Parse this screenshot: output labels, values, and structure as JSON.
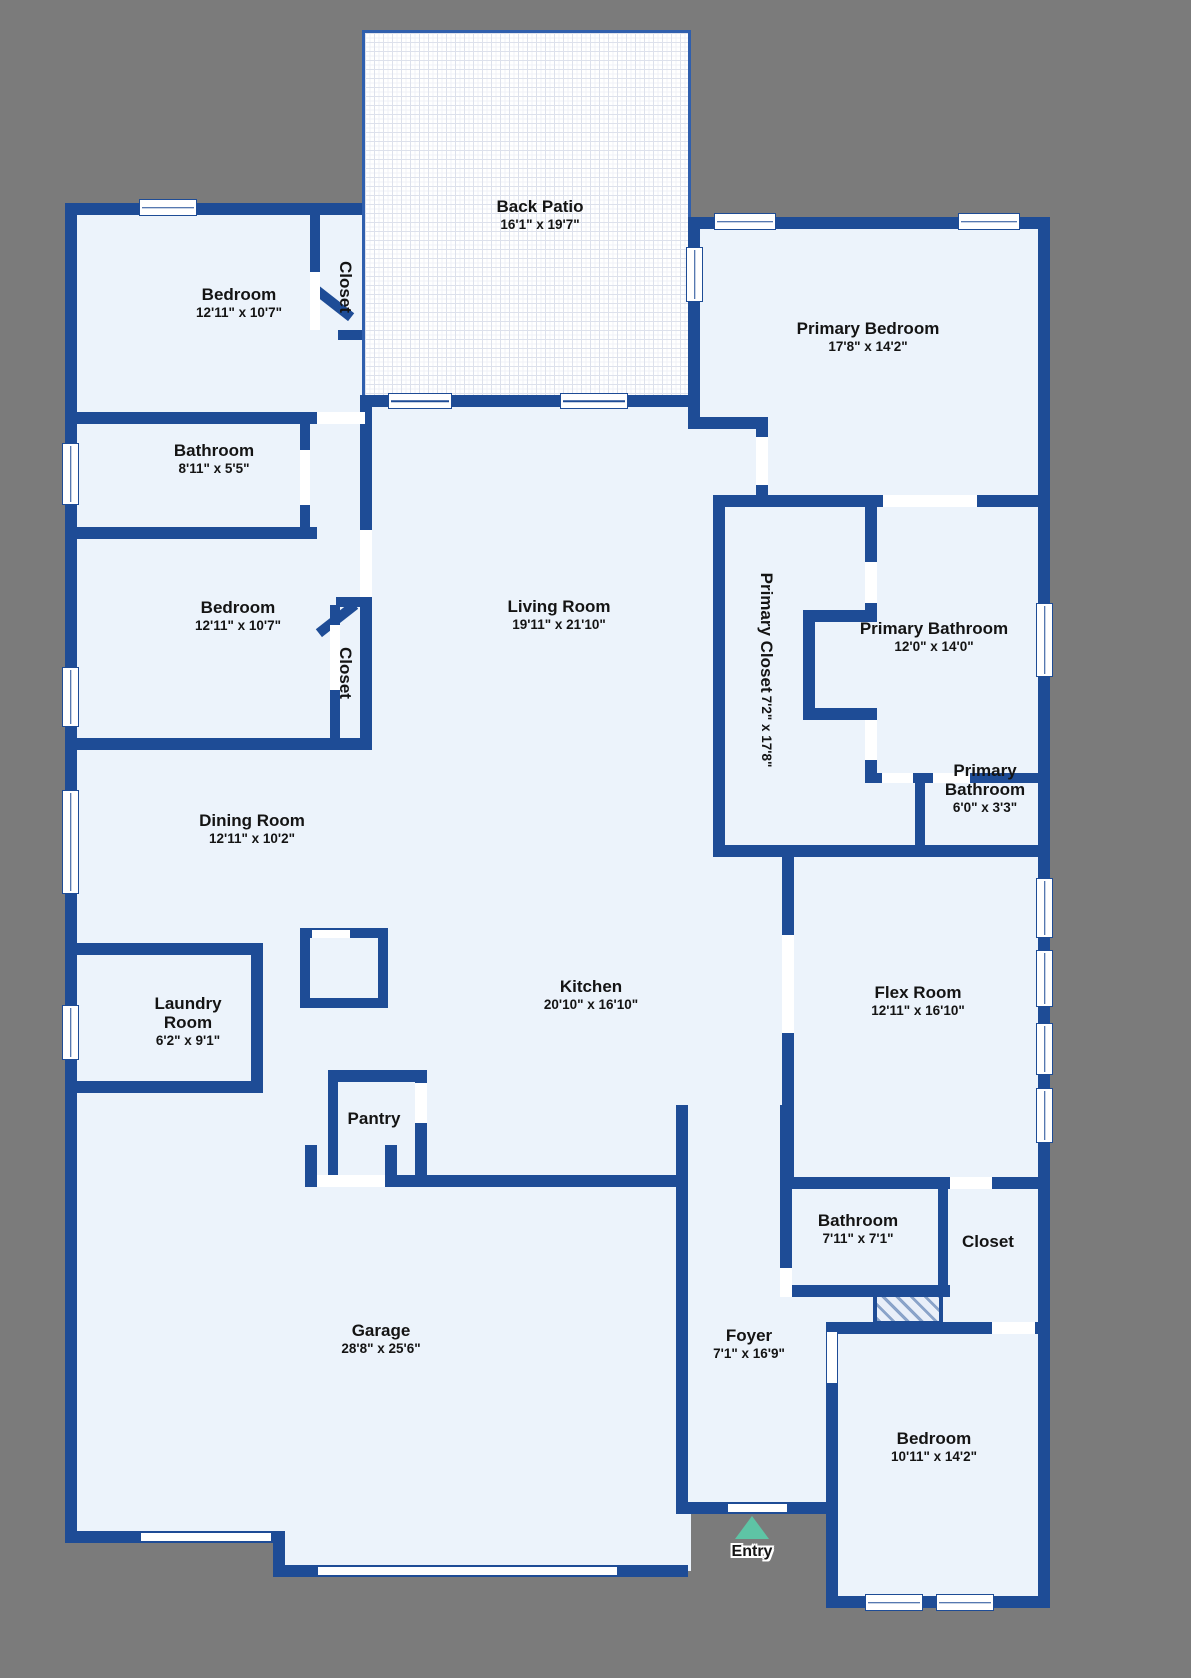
{
  "canvas": {
    "w": 1191,
    "h": 1678,
    "bg": "#7b7b7b"
  },
  "colors": {
    "wall": "#1e4c96",
    "floor": "#ecf3fb",
    "window_fill": "#ffffff",
    "door_fill": "#ffffff",
    "patio_border": "#2f5fae",
    "entry_arrow": "#5ec4a5",
    "label_text": "#141414"
  },
  "patio": {
    "x": 362,
    "y": 30,
    "w": 329,
    "h": 368
  },
  "floors": [
    [
      65,
      203,
      297,
      1340
    ],
    [
      352,
      395,
      339,
      1176
    ],
    [
      285,
      1400,
      80,
      170
    ],
    [
      688,
      217,
      362,
      1297
    ],
    [
      826,
      1322,
      224,
      286
    ]
  ],
  "walls": [
    [
      65,
      203,
      297,
      12
    ],
    [
      65,
      203,
      12,
      1340
    ],
    [
      65,
      1531,
      220,
      12
    ],
    [
      273,
      1531,
      12,
      46
    ],
    [
      273,
      1565,
      415,
      12
    ],
    [
      676,
      1105,
      12,
      409
    ],
    [
      676,
      1502,
      162,
      12
    ],
    [
      826,
      1322,
      12,
      286
    ],
    [
      826,
      1596,
      224,
      12
    ],
    [
      1038,
      217,
      12,
      1391
    ],
    [
      688,
      217,
      362,
      12
    ],
    [
      688,
      217,
      12,
      200
    ],
    [
      688,
      417,
      80,
      12
    ],
    [
      756,
      417,
      12,
      90
    ],
    [
      713,
      495,
      337,
      12
    ],
    [
      713,
      495,
      12,
      362
    ],
    [
      865,
      507,
      12,
      55
    ],
    [
      865,
      603,
      12,
      10
    ],
    [
      803,
      610,
      74,
      12
    ],
    [
      803,
      610,
      12,
      110
    ],
    [
      803,
      708,
      74,
      12
    ],
    [
      865,
      720,
      12,
      53
    ],
    [
      865,
      773,
      185,
      10
    ],
    [
      915,
      783,
      10,
      74
    ],
    [
      713,
      845,
      337,
      12
    ],
    [
      782,
      857,
      12,
      320
    ],
    [
      780,
      1105,
      12,
      192
    ],
    [
      780,
      1177,
      270,
      12
    ],
    [
      938,
      1189,
      10,
      108
    ],
    [
      780,
      1285,
      170,
      12
    ],
    [
      826,
      1322,
      224,
      12
    ],
    [
      360,
      395,
      331,
      12
    ],
    [
      360,
      395,
      12,
      355
    ],
    [
      65,
      412,
      252,
      12
    ],
    [
      300,
      412,
      10,
      115
    ],
    [
      65,
      527,
      252,
      12
    ],
    [
      310,
      215,
      10,
      57
    ],
    [
      338,
      330,
      24,
      10
    ],
    [
      336,
      597,
      28,
      10
    ],
    [
      330,
      605,
      10,
      133
    ],
    [
      65,
      738,
      307,
      12
    ],
    [
      65,
      943,
      198,
      12
    ],
    [
      251,
      955,
      12,
      138
    ],
    [
      65,
      1081,
      198,
      12
    ],
    [
      300,
      928,
      88,
      10
    ],
    [
      300,
      928,
      10,
      80
    ],
    [
      378,
      928,
      10,
      80
    ],
    [
      300,
      998,
      88,
      10
    ],
    [
      328,
      1070,
      99,
      12
    ],
    [
      328,
      1070,
      10,
      107
    ],
    [
      415,
      1070,
      12,
      107
    ],
    [
      305,
      1175,
      383,
      12
    ],
    [
      305,
      1145,
      12,
      42
    ],
    [
      385,
      1145,
      12,
      42
    ]
  ],
  "diagonals": [
    [
      310,
      298,
      46,
      10,
      38
    ],
    [
      314,
      614,
      46,
      10,
      -38
    ]
  ],
  "doors": [
    [
      317,
      412,
      48,
      12
    ],
    [
      300,
      450,
      10,
      55
    ],
    [
      310,
      272,
      10,
      58
    ],
    [
      330,
      625,
      10,
      65
    ],
    [
      360,
      530,
      12,
      67
    ],
    [
      756,
      437,
      12,
      48
    ],
    [
      865,
      562,
      12,
      41
    ],
    [
      865,
      720,
      12,
      40
    ],
    [
      882,
      773,
      31,
      10
    ],
    [
      933,
      773,
      37,
      10
    ],
    [
      782,
      935,
      12,
      98
    ],
    [
      780,
      1268,
      12,
      29
    ],
    [
      728,
      1504,
      59,
      8
    ],
    [
      827,
      1332,
      10,
      51
    ],
    [
      992,
      1322,
      43,
      12
    ],
    [
      415,
      1083,
      12,
      40
    ],
    [
      317,
      1175,
      68,
      12
    ],
    [
      950,
      1177,
      42,
      12
    ],
    [
      883,
      495,
      94,
      12
    ],
    [
      312,
      930,
      38,
      8
    ]
  ],
  "garage_doors": [
    [
      140,
      1532,
      132,
      10
    ],
    [
      317,
      1566,
      301,
      10
    ]
  ],
  "windows": [
    [
      139,
      199,
      58,
      17
    ],
    [
      714,
      213,
      62,
      17
    ],
    [
      958,
      213,
      62,
      17
    ],
    [
      686,
      247,
      17,
      55
    ],
    [
      62,
      443,
      17,
      62
    ],
    [
      62,
      667,
      17,
      60
    ],
    [
      62,
      790,
      17,
      104
    ],
    [
      62,
      1005,
      17,
      55
    ],
    [
      1036,
      603,
      17,
      74
    ],
    [
      1036,
      878,
      17,
      60
    ],
    [
      1036,
      950,
      17,
      57
    ],
    [
      1036,
      1023,
      17,
      52
    ],
    [
      1036,
      1088,
      17,
      55
    ],
    [
      865,
      1594,
      58,
      17
    ],
    [
      936,
      1594,
      58,
      17
    ],
    [
      388,
      393,
      64,
      16
    ],
    [
      560,
      393,
      68,
      16
    ]
  ],
  "hatch_box": {
    "x": 873,
    "y": 1293,
    "w": 70,
    "h": 32
  },
  "entry": {
    "label": "Entry",
    "cx": 752,
    "tri_top": 1516,
    "tri_h": 23,
    "label_cy": 1553
  },
  "rooms": [
    {
      "name": "Back Patio",
      "dims": "16'1\" x 19'7\"",
      "cx": 540,
      "cy": 208
    },
    {
      "name": "Bedroom",
      "dims": "12'11\" x 10'7\"",
      "cx": 239,
      "cy": 296
    },
    {
      "name": "Closet",
      "dims": "",
      "cx": 345,
      "cy": 287,
      "vertical": true
    },
    {
      "name": "Primary Bedroom",
      "dims": "17'8\" x 14'2\"",
      "cx": 868,
      "cy": 330
    },
    {
      "name": "Bathroom",
      "dims": "8'11\" x 5'5\"",
      "cx": 214,
      "cy": 452
    },
    {
      "name": "Bedroom",
      "dims": "12'11\" x 10'7\"",
      "cx": 238,
      "cy": 609
    },
    {
      "name": "Closet",
      "dims": "",
      "cx": 345,
      "cy": 673,
      "vertical": true
    },
    {
      "name": "Living Room",
      "dims": "19'11\" x 21'10\"",
      "cx": 559,
      "cy": 608
    },
    {
      "name": "Primary Closet",
      "dims": "7'2\" x 17'8\"",
      "cx": 766,
      "cy": 670,
      "vertical": true
    },
    {
      "name": "Primary Bathroom",
      "dims": "12'0\" x 14'0\"",
      "cx": 934,
      "cy": 630
    },
    {
      "name": "Primary",
      "name2": "Bathroom",
      "dims": "6'0\" x 3'3\"",
      "cx": 985,
      "cy": 772
    },
    {
      "name": "Dining Room",
      "dims": "12'11\" x 10'2\"",
      "cx": 252,
      "cy": 822
    },
    {
      "name": "Laundry",
      "name2": "Room",
      "dims": "6'2\" x 9'1\"",
      "cx": 188,
      "cy": 1005
    },
    {
      "name": "Kitchen",
      "dims": "20'10\" x 16'10\"",
      "cx": 591,
      "cy": 988
    },
    {
      "name": "Flex Room",
      "dims": "12'11\" x 16'10\"",
      "cx": 918,
      "cy": 994
    },
    {
      "name": "Pantry",
      "dims": "",
      "cx": 374,
      "cy": 1120
    },
    {
      "name": "Garage",
      "dims": "28'8\" x 25'6\"",
      "cx": 381,
      "cy": 1332
    },
    {
      "name": "Bathroom",
      "dims": "7'11\" x 7'1\"",
      "cx": 858,
      "cy": 1222
    },
    {
      "name": "Closet",
      "dims": "",
      "cx": 988,
      "cy": 1243
    },
    {
      "name": "Foyer",
      "dims": "7'1\" x 16'9\"",
      "cx": 749,
      "cy": 1337
    },
    {
      "name": "Bedroom",
      "dims": "10'11\" x 14'2\"",
      "cx": 934,
      "cy": 1440
    }
  ]
}
